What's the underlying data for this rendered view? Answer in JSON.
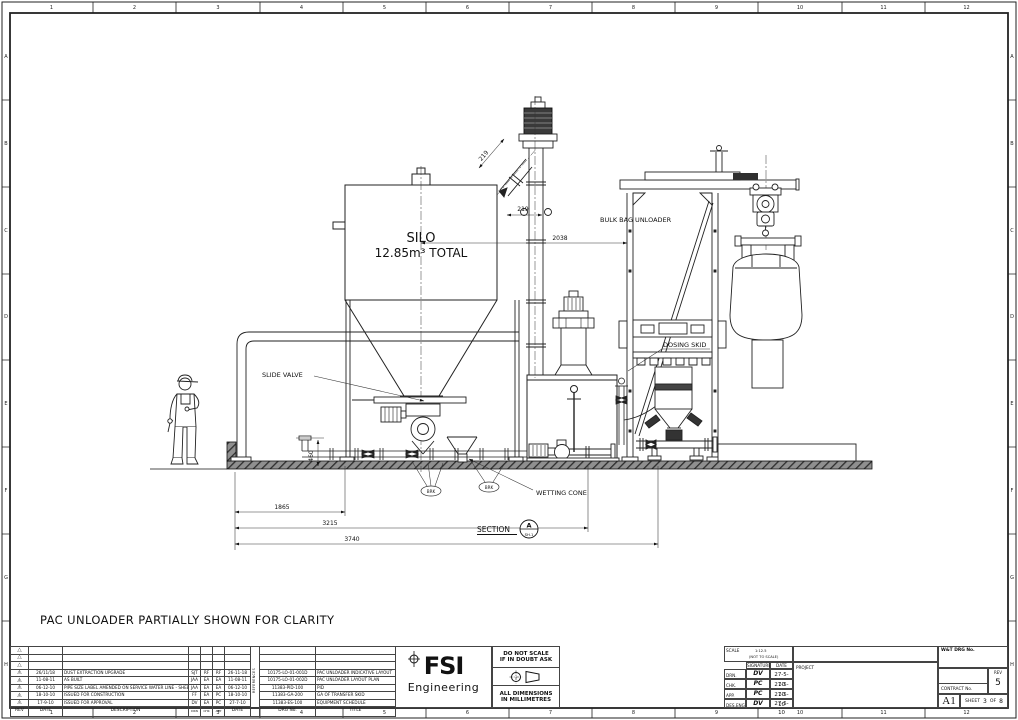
{
  "sheet": {
    "note": "PAC UNLOADER PARTIALLY SHOWN FOR CLARITY",
    "grid_cols": [
      "1",
      "2",
      "3",
      "4",
      "5",
      "6",
      "7",
      "8",
      "9",
      "10",
      "11",
      "12"
    ],
    "grid_rows": [
      "A",
      "B",
      "C",
      "D",
      "E",
      "F",
      "G",
      "H"
    ]
  },
  "drawing": {
    "silo": {
      "name": "SILO",
      "capacity": "12.85m³ TOTAL"
    },
    "labels": {
      "bulk_bag_unloader": "BULK BAG UNLOADER",
      "dosing_skid": "DOSING SKID",
      "slide_valve": "SLIDE VALVE",
      "wetting_cone": "WETTING CONE"
    },
    "section": {
      "label": "SECTION",
      "id": "A",
      "sheet": "SH.1"
    },
    "balloons": {
      "left": "BRK",
      "right": "BRK"
    },
    "dims": {
      "chute_width": "219",
      "offset": "219",
      "silo_to_unloader": "2038",
      "pipe_height": "460",
      "d1": "1865",
      "d2": "3215",
      "d3": "3740"
    }
  },
  "revision_table": {
    "headers": {
      "rev": "REV",
      "date": "DATE",
      "description": "DESCRIPTION",
      "drn": "DRN",
      "chk": "CHK",
      "app": "APP",
      "date2": "DATE"
    },
    "rows": [
      {
        "rev": "5",
        "date": "26/11/18",
        "description": "DUST EXTRACTION UPGRADE",
        "drn": "SJT",
        "chk": "RF",
        "app": "RF",
        "date2": "26-11-18"
      },
      {
        "rev": "4",
        "date": "11-08-11",
        "description": "AS BUILT",
        "drn": "JAA",
        "chk": "EA",
        "app": "EA",
        "date2": "11-08-11"
      },
      {
        "rev": "3",
        "date": "06-12-10",
        "description": "PIPE SIZE LABEL AMENDED ON SERVICE WATER LINE - SHEET 7",
        "drn": "JAA",
        "chk": "EA",
        "app": "EA",
        "date2": "06-12-10"
      },
      {
        "rev": "2",
        "date": "18-10-10",
        "description": "ISSUED FOR CONSTRUCTION",
        "drn": "FF",
        "chk": "EA",
        "app": "PC",
        "date2": "18-10-10"
      },
      {
        "rev": "1",
        "date": "17-9-10",
        "description": "ISSUED FOR APPROVAL",
        "drn": "DV",
        "chk": "EA",
        "app": "PC",
        "date2": "27-7-10"
      }
    ]
  },
  "references": {
    "side_label": "REFERENCES",
    "headers": {
      "no": "DRG No.",
      "title": "TITLE"
    },
    "rows": [
      {
        "no": "10175-LO-01-001D",
        "title": "PAC UNLOADER INDICATIVE LAYOUT"
      },
      {
        "no": "10175-LO-01-002D",
        "title": "PAC UNLOADER LAYOUT PLAN"
      },
      {
        "no": "11383-PID-100",
        "title": "PID"
      },
      {
        "no": "11383-GA-200",
        "title": "GA OF TRANSFER SKID"
      },
      {
        "no": "11383-ES-100",
        "title": "EQUIPMENT SCHEDULE"
      }
    ]
  },
  "logo": {
    "name": "FSI",
    "subtitle": "Engineering"
  },
  "stamp": {
    "do_not_scale": "DO NOT SCALE",
    "if_in_doubt": "IF IN DOUBT ASK",
    "all_dims": "ALL DIMENSIONS",
    "in_mm": "IN MILLIMETRES"
  },
  "title_block": {
    "scale_label": "SCALE",
    "scale_value": "1:12.5",
    "scale_note": "(NOT TO SCALE)",
    "signature_label": "SIGNATURE",
    "date_label": "DATE",
    "rows": [
      {
        "role": "DRN.",
        "sig": "DV",
        "date": "27-5-10"
      },
      {
        "role": "CHK.",
        "sig": "PC",
        "date": "27-5-10"
      },
      {
        "role": "APP.",
        "sig": "PC",
        "date": "27-5-10"
      },
      {
        "role": "DES.ENG",
        "sig": "DV",
        "date": "27-5-10"
      }
    ],
    "project_label": "PROJECT",
    "wt_drg_label": "W&T DRG No.",
    "contract_label": "CONTRACT No.",
    "rev_label": "REV",
    "rev_value": "5",
    "size": "A1",
    "sheet_label": "SHEET",
    "sheet_no": "3",
    "of_label": "OF",
    "sheet_total": "8"
  }
}
